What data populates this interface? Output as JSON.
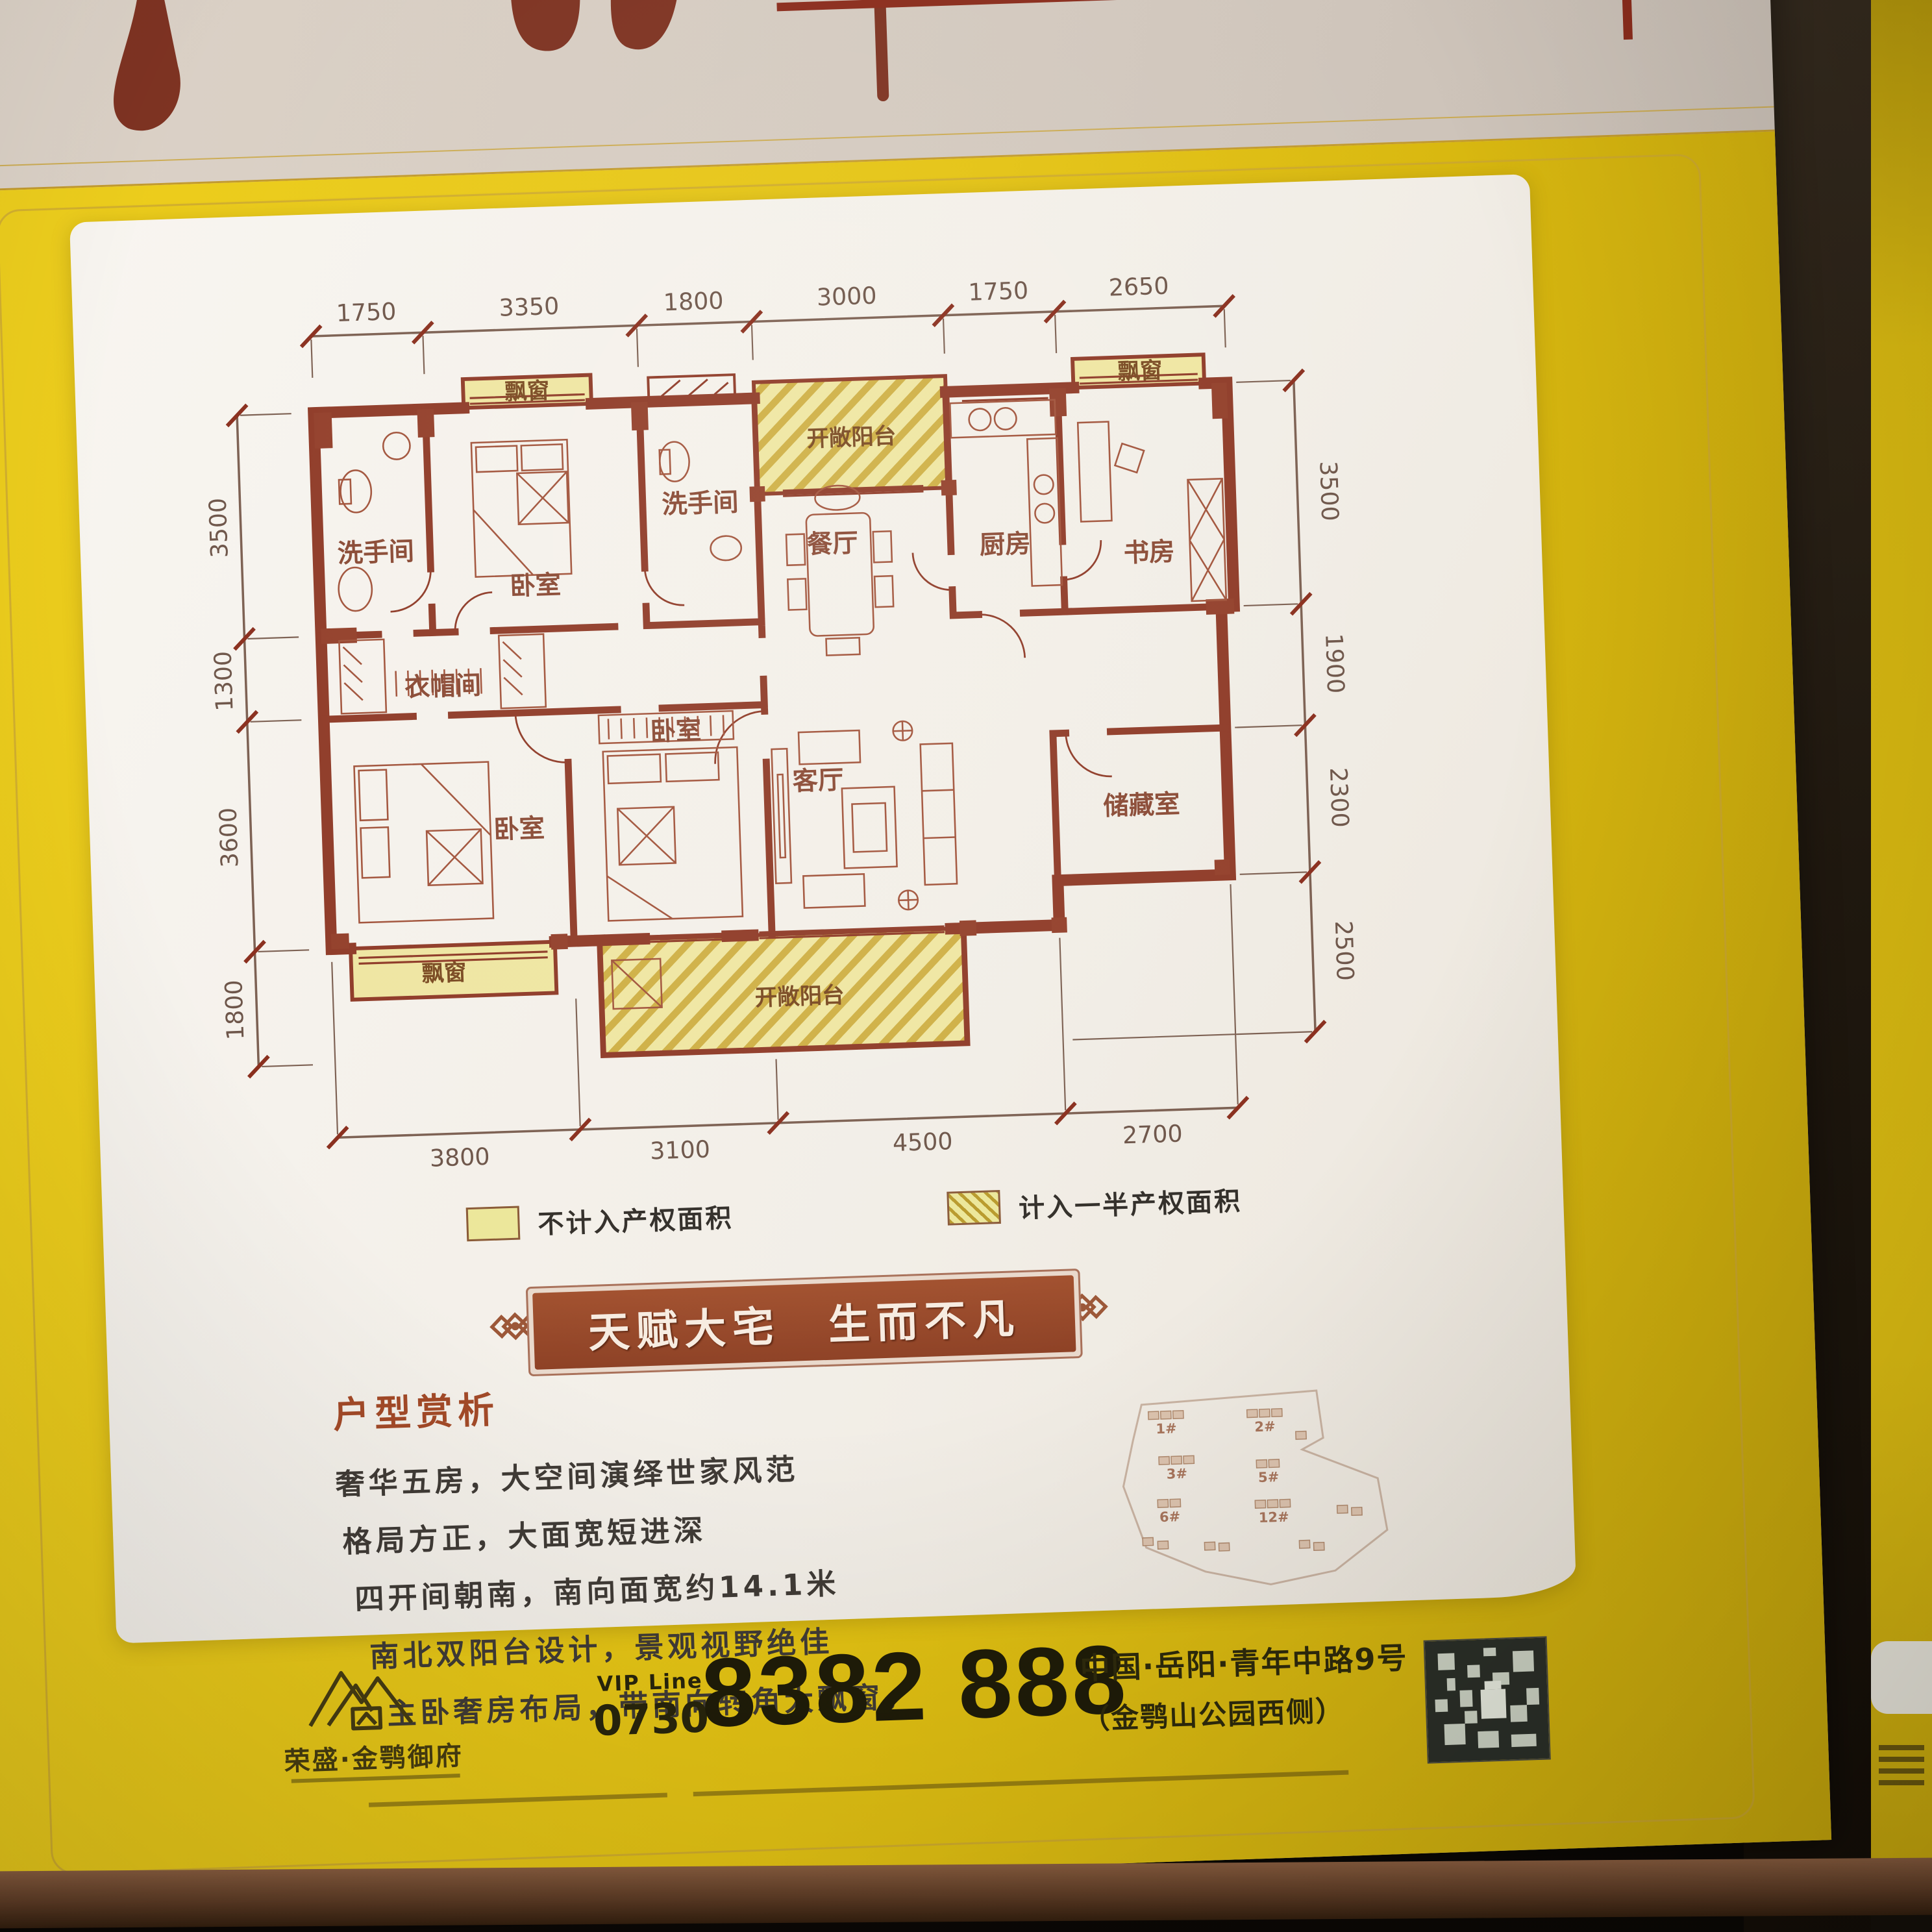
{
  "poster": {
    "plan": {
      "dims_top": [
        "1750",
        "3350",
        "1800",
        "3000",
        "1750",
        "2650"
      ],
      "dims_left": [
        "3500",
        "1300",
        "3600",
        "1800"
      ],
      "dims_right": [
        "3500",
        "1900",
        "2300",
        "2500"
      ],
      "dims_bottom": [
        "3800",
        "3100",
        "4500",
        "2700"
      ],
      "rooms": {
        "bay_window": "飘窗",
        "bath": "洗手间",
        "bedroom": "卧室",
        "open_balcony": "开敞阳台",
        "dining": "餐厅",
        "kitchen": "厨房",
        "study": "书房",
        "cloakroom": "衣帽间",
        "living": "客厅",
        "storage": "储藏室"
      }
    },
    "legend": {
      "solid": "不计入产权面积",
      "half": "计入一半产权面积"
    },
    "banner": "天赋大宅　生而不凡",
    "analysis": {
      "title": "户型赏析",
      "lines": [
        "奢华五房，大空间演绎世家风范",
        "格局方正，大面宽短进深",
        "四开间朝南，南向面宽约14.1米",
        "南北双阳台设计，景观视野绝佳",
        "主卧奢房布局，带南向转角大飘窗。"
      ]
    },
    "site_plan": {
      "labels": [
        "1#",
        "2#",
        "3#",
        "5#",
        "6#",
        "12#"
      ]
    },
    "footer": {
      "brand": "荣盛·金鹗御府",
      "vip_label": "VIP Line",
      "phone_area": "0730",
      "phone": "8382 888",
      "address_line1": "中国·岳阳·青年中路9号",
      "address_line2": "（金鹗山公园西侧）"
    },
    "colors": {
      "poster_yellow": "#e4c313",
      "plan_line": "#8f3b28",
      "bay_fill": "#efe6a2",
      "banner_bg": "#97482a"
    }
  }
}
